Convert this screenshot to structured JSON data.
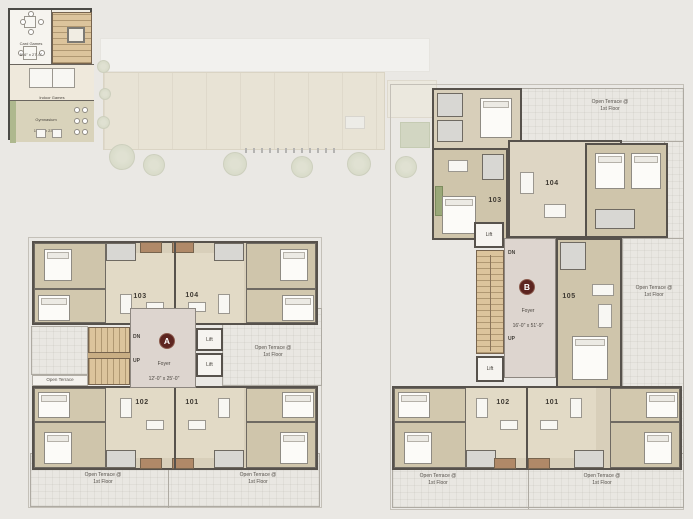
{
  "palette": {
    "page_bg": "#eae8e4",
    "wall": "#57524c",
    "room_tan": "#cfc5ab",
    "room_light": "#e2dac6",
    "foyer": "#ddd5cf",
    "stair": "#dcc49c",
    "terrace": "#e9e7e2",
    "badge_bg": "#5d2520",
    "balcony": "#b08968"
  },
  "clubhouse": {
    "card_games_label": "Card Games",
    "card_games_dim": "5'-6\" x 27'-0\"",
    "indoor_games_label": "Indoor Games",
    "indoor_games_dim": "16'-9\" x 22'-3\"",
    "gym_label": "Gymnasium",
    "gym_dim": "16'-9\" x 23'-3\""
  },
  "block_a": {
    "badge": "A",
    "foyer_label": "Foyer",
    "foyer_dim": "12'-0\" x 25'-0\"",
    "dn": "DN",
    "up": "UP",
    "lift_top": "Lift",
    "lift_bottom": "Lift",
    "units": {
      "u103": "103",
      "u104": "104",
      "u102": "102",
      "u101": "101"
    },
    "terrace_left_top": "Open Terrace",
    "terrace_left_bottom": "Open Terrace",
    "terrace_right": "Open Terrace @\n1st Floor",
    "terrace_bottom_left": "Open Terrace @\n1st Floor",
    "terrace_bottom_right": "Open Terrace @\n1st Floor"
  },
  "block_b": {
    "badge": "B",
    "foyer_label": "Foyer",
    "foyer_dim": "16'-0\" x 51'-9\"",
    "dn": "DN",
    "up": "UP",
    "lift_top": "Lift",
    "lift_bottom": "Lift",
    "units": {
      "u103": "103",
      "u104": "104",
      "u105": "105",
      "u102": "102",
      "u101": "101"
    },
    "terrace_top": "Open Terrace @\n1st Floor",
    "terrace_right": "Open Terrace @\n1st Floor",
    "terrace_bottom_left": "Open Terrace @\n1st Floor",
    "terrace_bottom_right": "Open Terrace @\n1st Floor"
  }
}
